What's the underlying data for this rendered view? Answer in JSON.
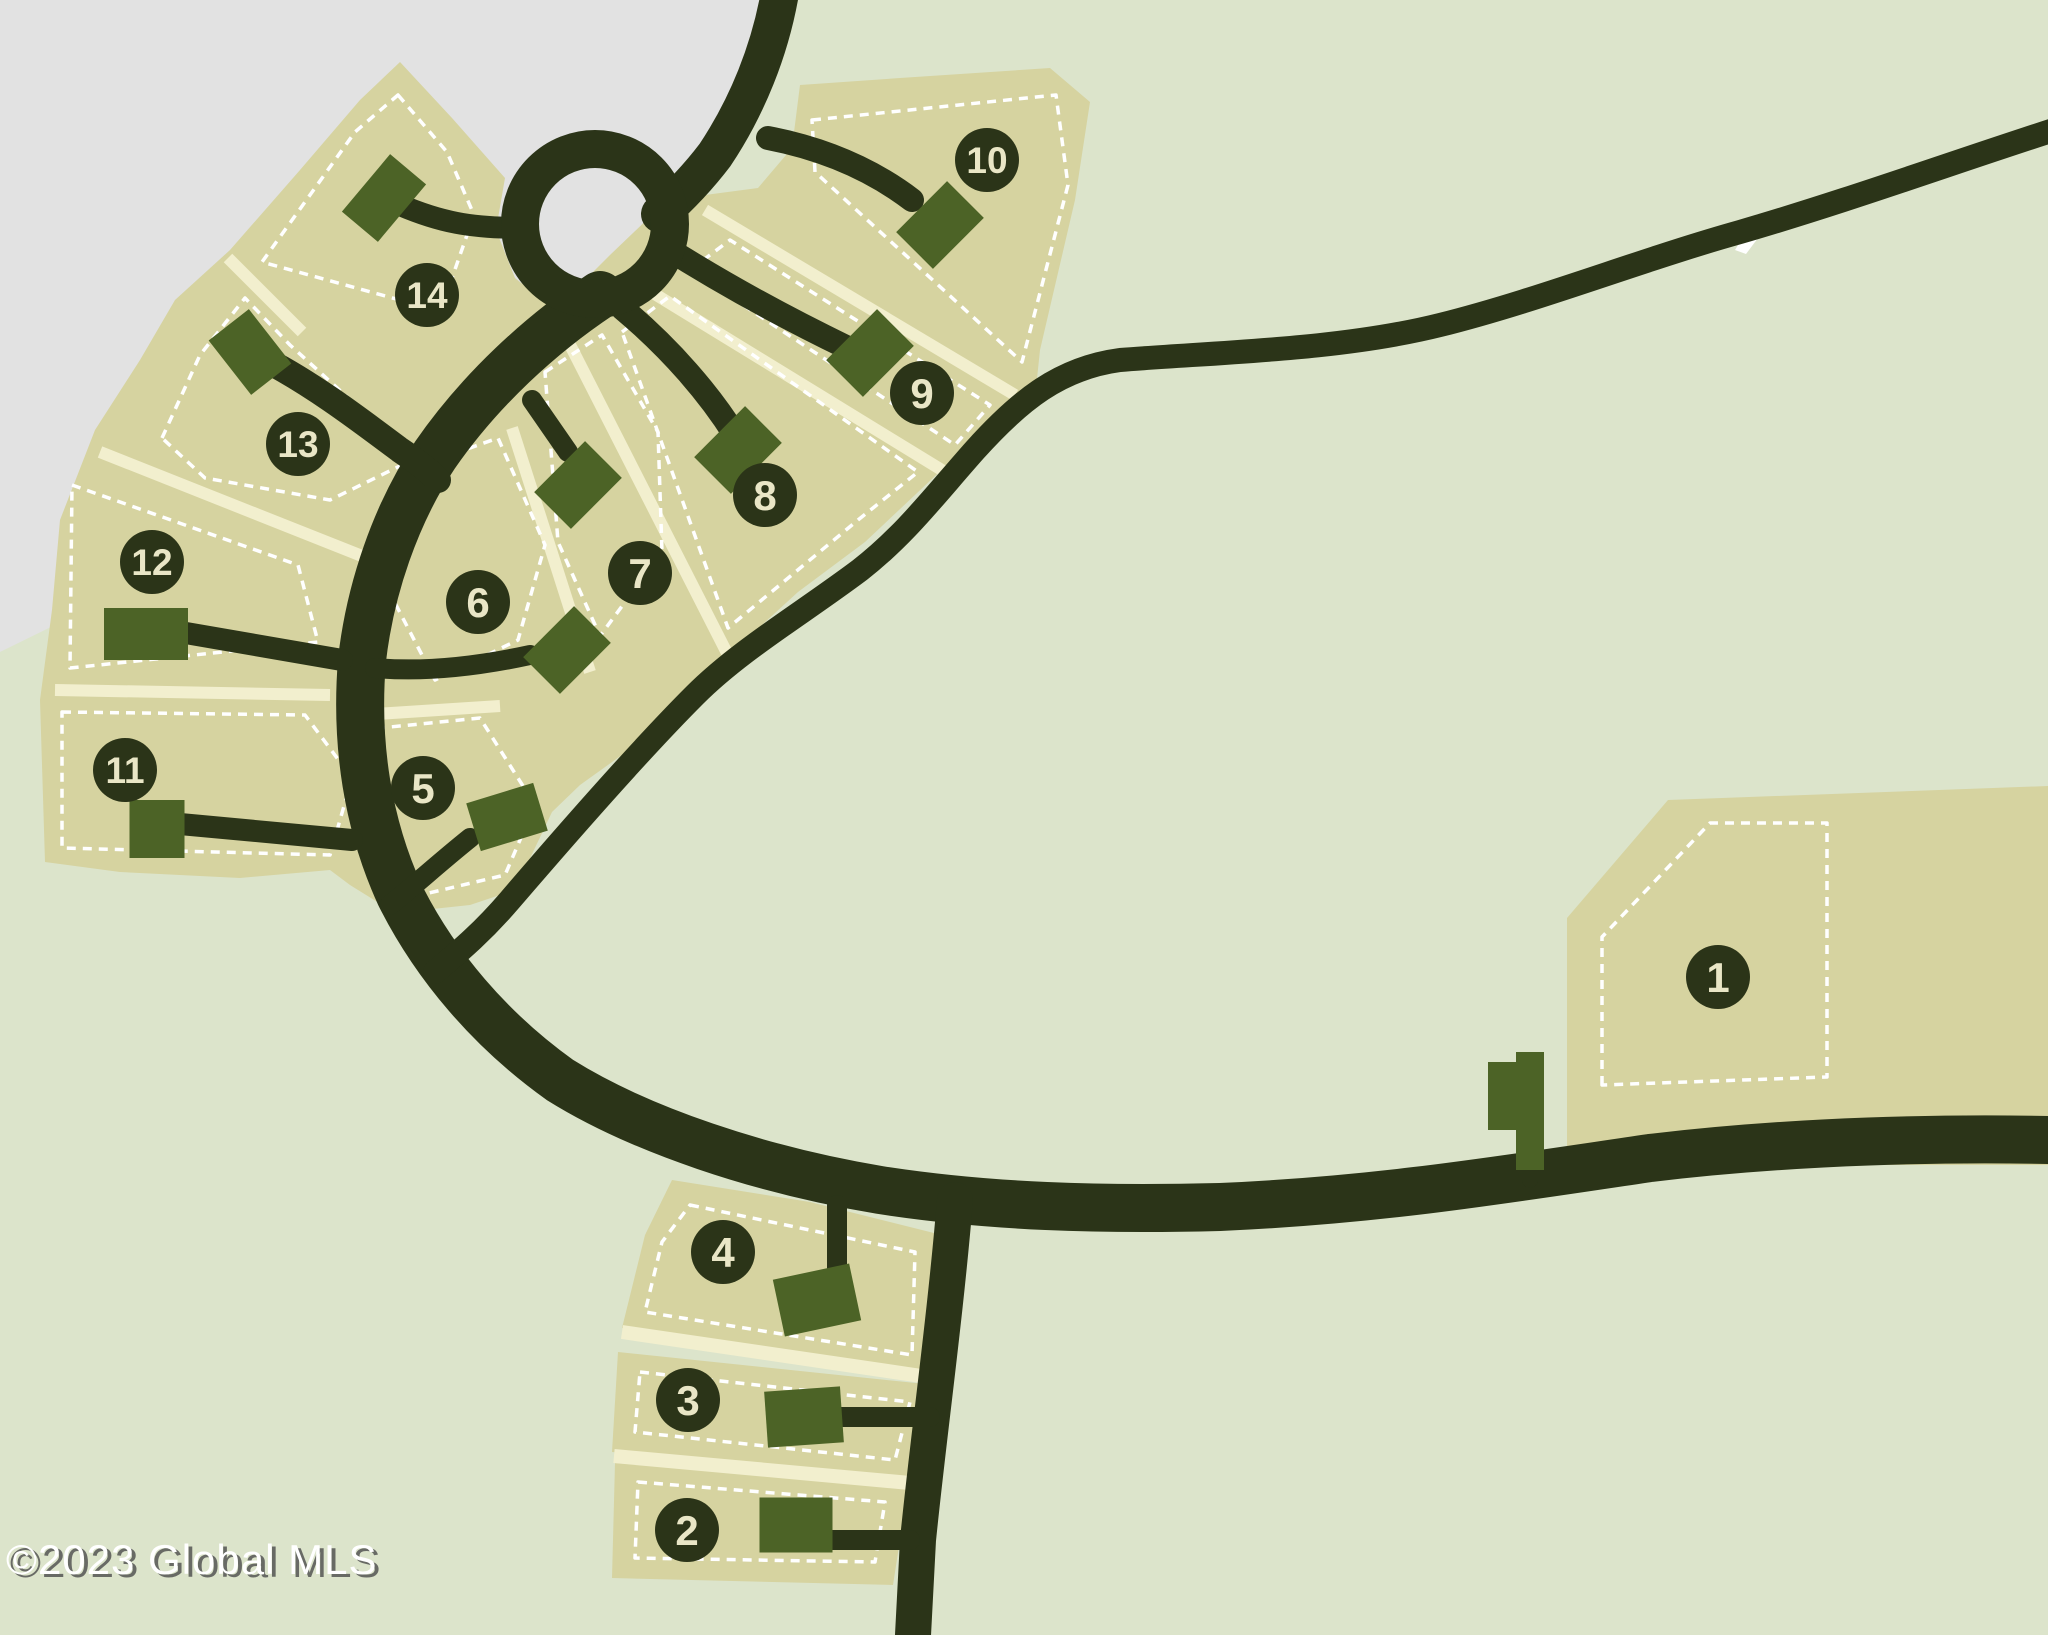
{
  "copyright": "©2023 Global MLS",
  "colors": {
    "background_green": "#dce4cb",
    "background_gray": "#e2e2e2",
    "lot_tan": "#d6d3a0",
    "divider_cream": "#f2efce",
    "road_dark": "#2b3418",
    "building_green": "#4c6326",
    "dash_white": "#ffffff",
    "badge_fill": "#2b3418",
    "badge_text": "#e9e6c6"
  },
  "map": {
    "width": 2048,
    "height": 1635,
    "gray_region": [
      [
        0,
        0
      ],
      [
        765,
        0
      ],
      [
        742,
        95
      ],
      [
        700,
        160
      ],
      [
        640,
        205
      ],
      [
        600,
        250
      ],
      [
        575,
        300
      ],
      [
        545,
        330
      ],
      [
        460,
        390
      ],
      [
        350,
        452
      ],
      [
        240,
        512
      ],
      [
        130,
        572
      ],
      [
        55,
        625
      ],
      [
        0,
        652
      ]
    ],
    "loop": {
      "cx": 595,
      "cy": 224,
      "inner_r": 58,
      "ring_r": 75,
      "ring_width": 38
    },
    "white_patch": [
      [
        1735,
        250
      ],
      [
        1757,
        214
      ],
      [
        1770,
        222
      ],
      [
        1746,
        254
      ]
    ],
    "tan_regions": [
      {
        "name": "fan-lots-5-14",
        "points": [
          [
            45,
            862
          ],
          [
            40,
            700
          ],
          [
            52,
            610
          ],
          [
            60,
            520
          ],
          [
            95,
            430
          ],
          [
            140,
            360
          ],
          [
            175,
            300
          ],
          [
            230,
            250
          ],
          [
            300,
            170
          ],
          [
            360,
            100
          ],
          [
            400,
            62
          ],
          [
            452,
            118
          ],
          [
            505,
            178
          ],
          [
            496,
            230
          ],
          [
            515,
            278
          ],
          [
            555,
            310
          ],
          [
            610,
            255
          ],
          [
            655,
            212
          ],
          [
            705,
            195
          ],
          [
            758,
            188
          ],
          [
            792,
            148
          ],
          [
            800,
            85
          ],
          [
            900,
            78
          ],
          [
            1050,
            68
          ],
          [
            1090,
            102
          ],
          [
            1075,
            200
          ],
          [
            1040,
            350
          ],
          [
            1035,
            398
          ],
          [
            950,
            462
          ],
          [
            865,
            542
          ],
          [
            798,
            592
          ],
          [
            740,
            645
          ],
          [
            697,
            690
          ],
          [
            640,
            742
          ],
          [
            580,
            785
          ],
          [
            552,
            812
          ],
          [
            515,
            890
          ],
          [
            470,
            905
          ],
          [
            395,
            913
          ],
          [
            350,
            885
          ],
          [
            330,
            870
          ],
          [
            240,
            878
          ],
          [
            120,
            872
          ]
        ]
      },
      {
        "name": "lot-4",
        "points": [
          [
            672,
            1180
          ],
          [
            810,
            1202
          ],
          [
            938,
            1234
          ],
          [
            933,
            1372
          ],
          [
            622,
            1328
          ],
          [
            645,
            1235
          ]
        ]
      },
      {
        "name": "lot-3",
        "points": [
          [
            618,
            1352
          ],
          [
            935,
            1385
          ],
          [
            912,
            1478
          ],
          [
            612,
            1452
          ]
        ]
      },
      {
        "name": "lot-2",
        "points": [
          [
            615,
            1463
          ],
          [
            908,
            1488
          ],
          [
            893,
            1585
          ],
          [
            612,
            1578
          ]
        ]
      },
      {
        "name": "lot-1",
        "points": [
          [
            1567,
            918
          ],
          [
            1668,
            800
          ],
          [
            2048,
            786
          ],
          [
            2048,
            1165
          ],
          [
            1567,
            1165
          ]
        ]
      }
    ],
    "cream_dividers": [
      {
        "name": "divider-14-13",
        "x1": 228,
        "y1": 258,
        "x2": 302,
        "y2": 332,
        "w": 12
      },
      {
        "name": "divider-13-12",
        "x1": 100,
        "y1": 452,
        "x2": 362,
        "y2": 556,
        "w": 12
      },
      {
        "name": "divider-12-11",
        "x1": 55,
        "y1": 690,
        "x2": 330,
        "y2": 695,
        "w": 12
      },
      {
        "name": "divider-6-5",
        "x1": 345,
        "y1": 716,
        "x2": 500,
        "y2": 706,
        "w": 12
      },
      {
        "name": "divider-6-7",
        "x1": 512,
        "y1": 428,
        "x2": 590,
        "y2": 672,
        "w": 12
      },
      {
        "name": "divider-7-8",
        "x1": 565,
        "y1": 335,
        "x2": 728,
        "y2": 655,
        "w": 12
      },
      {
        "name": "divider-8-9",
        "x1": 640,
        "y1": 285,
        "x2": 950,
        "y2": 475,
        "w": 12
      },
      {
        "name": "divider-9-10",
        "x1": 705,
        "y1": 210,
        "x2": 1015,
        "y2": 395,
        "w": 12
      },
      {
        "name": "divider-4-3",
        "x1": 622,
        "y1": 1332,
        "x2": 935,
        "y2": 1378,
        "w": 14
      },
      {
        "name": "divider-3-2",
        "x1": 614,
        "y1": 1456,
        "x2": 910,
        "y2": 1483,
        "w": 14
      }
    ],
    "dashed_insets": [
      {
        "lot": "14",
        "points": [
          [
            398,
            95
          ],
          [
            447,
            152
          ],
          [
            474,
            215
          ],
          [
            452,
            278
          ],
          [
            418,
            305
          ],
          [
            262,
            262
          ],
          [
            310,
            195
          ],
          [
            355,
            132
          ]
        ]
      },
      {
        "lot": "13",
        "points": [
          [
            162,
            438
          ],
          [
            200,
            355
          ],
          [
            245,
            298
          ],
          [
            290,
            345
          ],
          [
            345,
            395
          ],
          [
            408,
            462
          ],
          [
            330,
            500
          ],
          [
            205,
            478
          ]
        ]
      },
      {
        "lot": "12",
        "points": [
          [
            72,
            485
          ],
          [
            298,
            565
          ],
          [
            318,
            642
          ],
          [
            70,
            668
          ]
        ]
      },
      {
        "lot": "11",
        "points": [
          [
            62,
            712
          ],
          [
            305,
            715
          ],
          [
            352,
            778
          ],
          [
            330,
            855
          ],
          [
            62,
            848
          ]
        ]
      },
      {
        "lot": "6",
        "points": [
          [
            408,
            470
          ],
          [
            498,
            438
          ],
          [
            545,
            545
          ],
          [
            518,
            640
          ],
          [
            435,
            680
          ],
          [
            382,
            578
          ]
        ]
      },
      {
        "lot": "5",
        "points": [
          [
            360,
            730
          ],
          [
            480,
            718
          ],
          [
            535,
            805
          ],
          [
            505,
            875
          ],
          [
            408,
            898
          ]
        ]
      },
      {
        "lot": "7",
        "points": [
          [
            545,
            372
          ],
          [
            602,
            335
          ],
          [
            658,
            432
          ],
          [
            662,
            552
          ],
          [
            600,
            636
          ],
          [
            558,
            542
          ]
        ]
      },
      {
        "lot": "8",
        "points": [
          [
            622,
            332
          ],
          [
            670,
            296
          ],
          [
            918,
            472
          ],
          [
            858,
            520
          ],
          [
            728,
            628
          ]
        ]
      },
      {
        "lot": "9",
        "points": [
          [
            690,
            270
          ],
          [
            730,
            240
          ],
          [
            990,
            405
          ],
          [
            955,
            445
          ]
        ]
      },
      {
        "lot": "10",
        "points": [
          [
            812,
            120
          ],
          [
            1056,
            95
          ],
          [
            1068,
            185
          ],
          [
            1022,
            362
          ],
          [
            815,
            172
          ]
        ]
      },
      {
        "lot": "4",
        "points": [
          [
            690,
            1205
          ],
          [
            915,
            1252
          ],
          [
            912,
            1355
          ],
          [
            645,
            1312
          ],
          [
            662,
            1242
          ]
        ]
      },
      {
        "lot": "3",
        "points": [
          [
            640,
            1372
          ],
          [
            910,
            1402
          ],
          [
            895,
            1460
          ],
          [
            635,
            1432
          ]
        ]
      },
      {
        "lot": "2",
        "points": [
          [
            638,
            1482
          ],
          [
            885,
            1502
          ],
          [
            875,
            1562
          ],
          [
            635,
            1558
          ]
        ]
      },
      {
        "lot": "1",
        "points": [
          [
            1602,
            1085
          ],
          [
            1602,
            937
          ],
          [
            1710,
            823
          ],
          [
            1827,
            823
          ],
          [
            1827,
            1077
          ]
        ]
      }
    ],
    "roads": [
      {
        "name": "main-road-top",
        "d": "M 782,-20 C 772,50 745,110 715,155 C 696,180 678,198 660,214",
        "w": 38
      },
      {
        "name": "main-road-arc",
        "d": "M 600,295 C 540,335 480,390 435,455 C 395,515 370,590 362,660 C 355,745 368,825 400,895 C 435,965 490,1030 560,1080 C 640,1130 760,1170 880,1190 C 990,1207 1100,1210 1220,1207 C 1380,1200 1500,1180 1650,1158 C 1800,1140 1950,1138 2048,1140",
        "w": 48
      },
      {
        "name": "country-road",
        "d": "M 2060,128 C 1960,160 1850,200 1740,232 C 1640,260 1540,300 1440,325 C 1340,350 1220,352 1120,360 C 1060,368 1020,400 975,450 C 935,495 905,535 860,570 C 800,615 740,650 695,695 C 640,750 570,830 510,900 C 480,935 455,955 435,972",
        "w": 24
      },
      {
        "name": "vertical-road",
        "d": "M 955,1200 C 945,1320 928,1440 918,1540 L 913,1635",
        "w": 36
      },
      {
        "name": "street-13",
        "d": "M 262,358 C 310,382 360,420 400,450 C 418,462 428,470 438,480",
        "w": 26
      },
      {
        "name": "street-8",
        "d": "M 622,308 C 672,350 710,395 735,435",
        "w": 24
      },
      {
        "name": "street-9",
        "d": "M 662,245 C 725,285 790,320 848,348",
        "w": 24
      },
      {
        "name": "street-10",
        "d": "M 768,138 C 820,148 870,168 912,200",
        "w": 24
      },
      {
        "name": "driveway-14",
        "d": "M 400,205 C 440,222 470,228 522,228",
        "w": 22
      },
      {
        "name": "driveway-12",
        "d": "M 180,632 L 342,660",
        "w": 22
      },
      {
        "name": "driveway-11",
        "d": "M 180,824 L 352,840",
        "w": 22
      },
      {
        "name": "driveway-7",
        "d": "M 532,400 L 568,452",
        "w": 20
      },
      {
        "name": "driveway-6",
        "d": "M 530,655 C 470,668 420,672 375,668",
        "w": 20
      },
      {
        "name": "driveway-5",
        "d": "M 470,838 C 440,862 415,885 390,905",
        "w": 20
      },
      {
        "name": "driveway-4",
        "d": "M 837,1205 L 837,1272",
        "w": 20
      },
      {
        "name": "driveway-3",
        "d": "M 838,1417 L 930,1417",
        "w": 20
      },
      {
        "name": "driveway-2",
        "d": "M 830,1540 L 910,1540",
        "w": 20
      },
      {
        "name": "driveway-1",
        "d": "M 1530,1155 L 1530,1180",
        "w": 16
      }
    ],
    "buildings": [
      {
        "lot": "14",
        "cx": 384,
        "cy": 198,
        "w": 75,
        "h": 47,
        "rot": -50
      },
      {
        "lot": "13",
        "cx": 250,
        "cy": 352,
        "w": 51,
        "h": 69,
        "rot": -38
      },
      {
        "lot": "12",
        "cx": 146,
        "cy": 634,
        "w": 84,
        "h": 52,
        "rot": 0
      },
      {
        "lot": "11",
        "cx": 157,
        "cy": 829,
        "w": 55,
        "h": 58,
        "rot": 0
      },
      {
        "lot": "10",
        "cx": 940,
        "cy": 225,
        "w": 52,
        "h": 72,
        "rot": 45
      },
      {
        "lot": "9",
        "cx": 870,
        "cy": 353,
        "w": 52,
        "h": 72,
        "rot": 45
      },
      {
        "lot": "8",
        "cx": 738,
        "cy": 450,
        "w": 52,
        "h": 72,
        "rot": 45
      },
      {
        "lot": "7",
        "cx": 578,
        "cy": 485,
        "w": 52,
        "h": 72,
        "rot": 45
      },
      {
        "lot": "6",
        "cx": 567,
        "cy": 650,
        "w": 52,
        "h": 72,
        "rot": 45
      },
      {
        "lot": "5",
        "cx": 507,
        "cy": 817,
        "w": 70,
        "h": 50,
        "rot": -17
      },
      {
        "lot": "4",
        "cx": 817,
        "cy": 1300,
        "w": 78,
        "h": 58,
        "rot": -12
      },
      {
        "lot": "3",
        "cx": 804,
        "cy": 1417,
        "w": 76,
        "h": 56,
        "rot": -4
      },
      {
        "lot": "2",
        "cx": 796,
        "cy": 1525,
        "w": 73,
        "h": 55,
        "rot": 0
      },
      {
        "lot": "1a",
        "cx": 1530,
        "cy": 1111,
        "w": 28,
        "h": 118,
        "rot": 0
      },
      {
        "lot": "1b",
        "cx": 1503,
        "cy": 1096,
        "w": 30,
        "h": 68,
        "rot": 0
      }
    ],
    "badges": [
      {
        "label": "1",
        "x": 1718,
        "y": 977
      },
      {
        "label": "2",
        "x": 687,
        "y": 1530
      },
      {
        "label": "3",
        "x": 688,
        "y": 1400
      },
      {
        "label": "4",
        "x": 723,
        "y": 1252
      },
      {
        "label": "5",
        "x": 423,
        "y": 788
      },
      {
        "label": "6",
        "x": 478,
        "y": 602
      },
      {
        "label": "7",
        "x": 640,
        "y": 573
      },
      {
        "label": "8",
        "x": 765,
        "y": 495
      },
      {
        "label": "9",
        "x": 922,
        "y": 393
      },
      {
        "label": "10",
        "x": 987,
        "y": 160
      },
      {
        "label": "11",
        "x": 125,
        "y": 770
      },
      {
        "label": "12",
        "x": 152,
        "y": 562
      },
      {
        "label": "13",
        "x": 298,
        "y": 444
      },
      {
        "label": "14",
        "x": 427,
        "y": 295
      }
    ],
    "badge_radius": 32
  }
}
